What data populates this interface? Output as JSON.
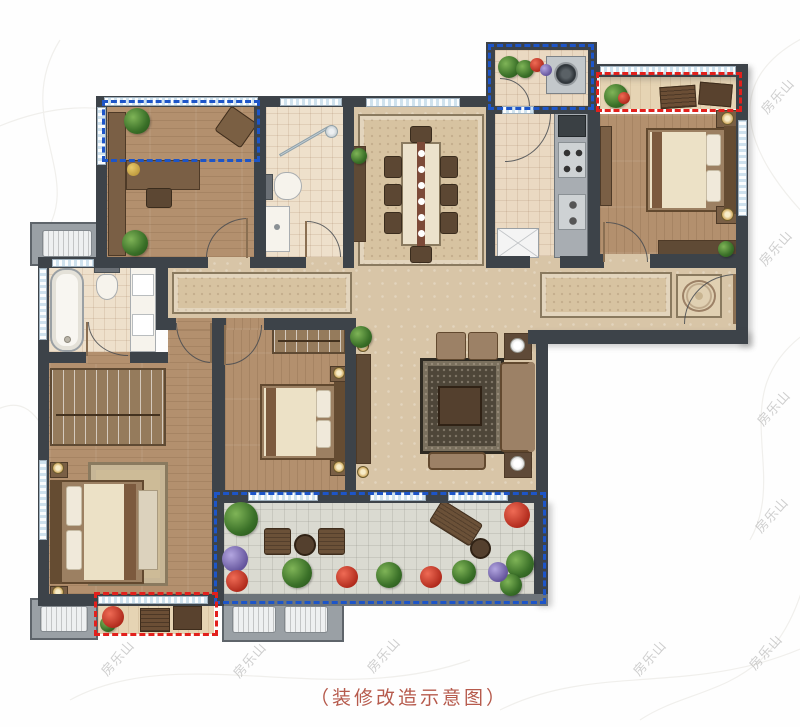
{
  "caption": {
    "text": "（装修改造示意图）"
  },
  "watermark": {
    "text": "房乐山"
  },
  "colors": {
    "annotation_blue": "#1d55c8",
    "annotation_red": "#e2201c",
    "caption_text": "#b65a4c",
    "wall": "#3d4349"
  }
}
